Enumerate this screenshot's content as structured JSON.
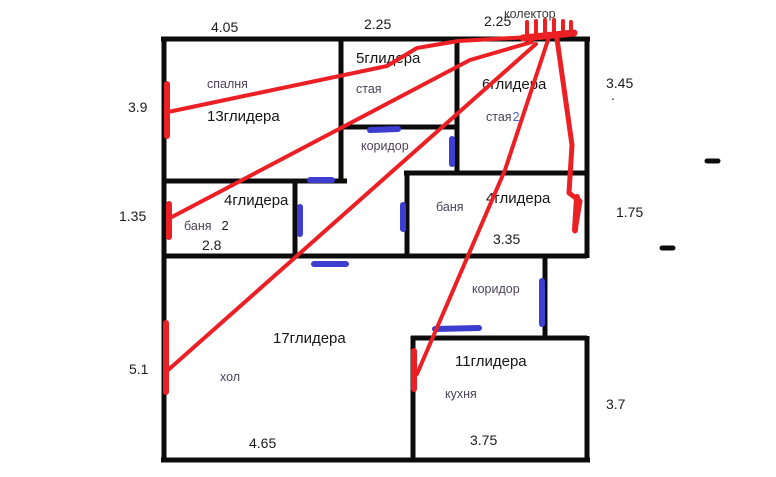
{
  "colors": {
    "wall": "#0c0c0c",
    "pipe": "#ec2024",
    "radiator_blue": "#3d3dd0",
    "room_label": "#4b4257",
    "number_label": "#1b1b1b",
    "blue_number": "#4a6bcf"
  },
  "collector": {
    "label": "колектор"
  },
  "rooms": {
    "spalnya": {
      "label": "спалня",
      "gliders": "13глидера"
    },
    "staya": {
      "label": "стая",
      "gliders": "5глидера"
    },
    "staya2": {
      "label": "стая",
      "number": "2",
      "gliders": "6глидера"
    },
    "koridor_top": {
      "label": "коридор"
    },
    "banya2": {
      "label": "баня",
      "number": "2",
      "gliders": "4глидера",
      "inner_width": "2.8"
    },
    "banya": {
      "label": "баня",
      "gliders": "4глидера",
      "inner_width": "3.35"
    },
    "koridor_bottom": {
      "label": "коридор"
    },
    "hol": {
      "label": "хол",
      "gliders": "17глидера",
      "inner_width": "4.65"
    },
    "kuhnya": {
      "label": "кухня",
      "gliders": "11глидера",
      "inner_width": "3.75"
    }
  },
  "dimensions": {
    "top_spalnya": "4.05",
    "top_staya": "2.25",
    "top_staya2": "2.25",
    "left_spalnya": "3.9",
    "left_banya2": "1.35",
    "left_hol": "5.1",
    "right_staya2": "3.45",
    "right_staya2_dot": ".",
    "right_banya": "1.75",
    "right_kuhnya": "3.7"
  }
}
